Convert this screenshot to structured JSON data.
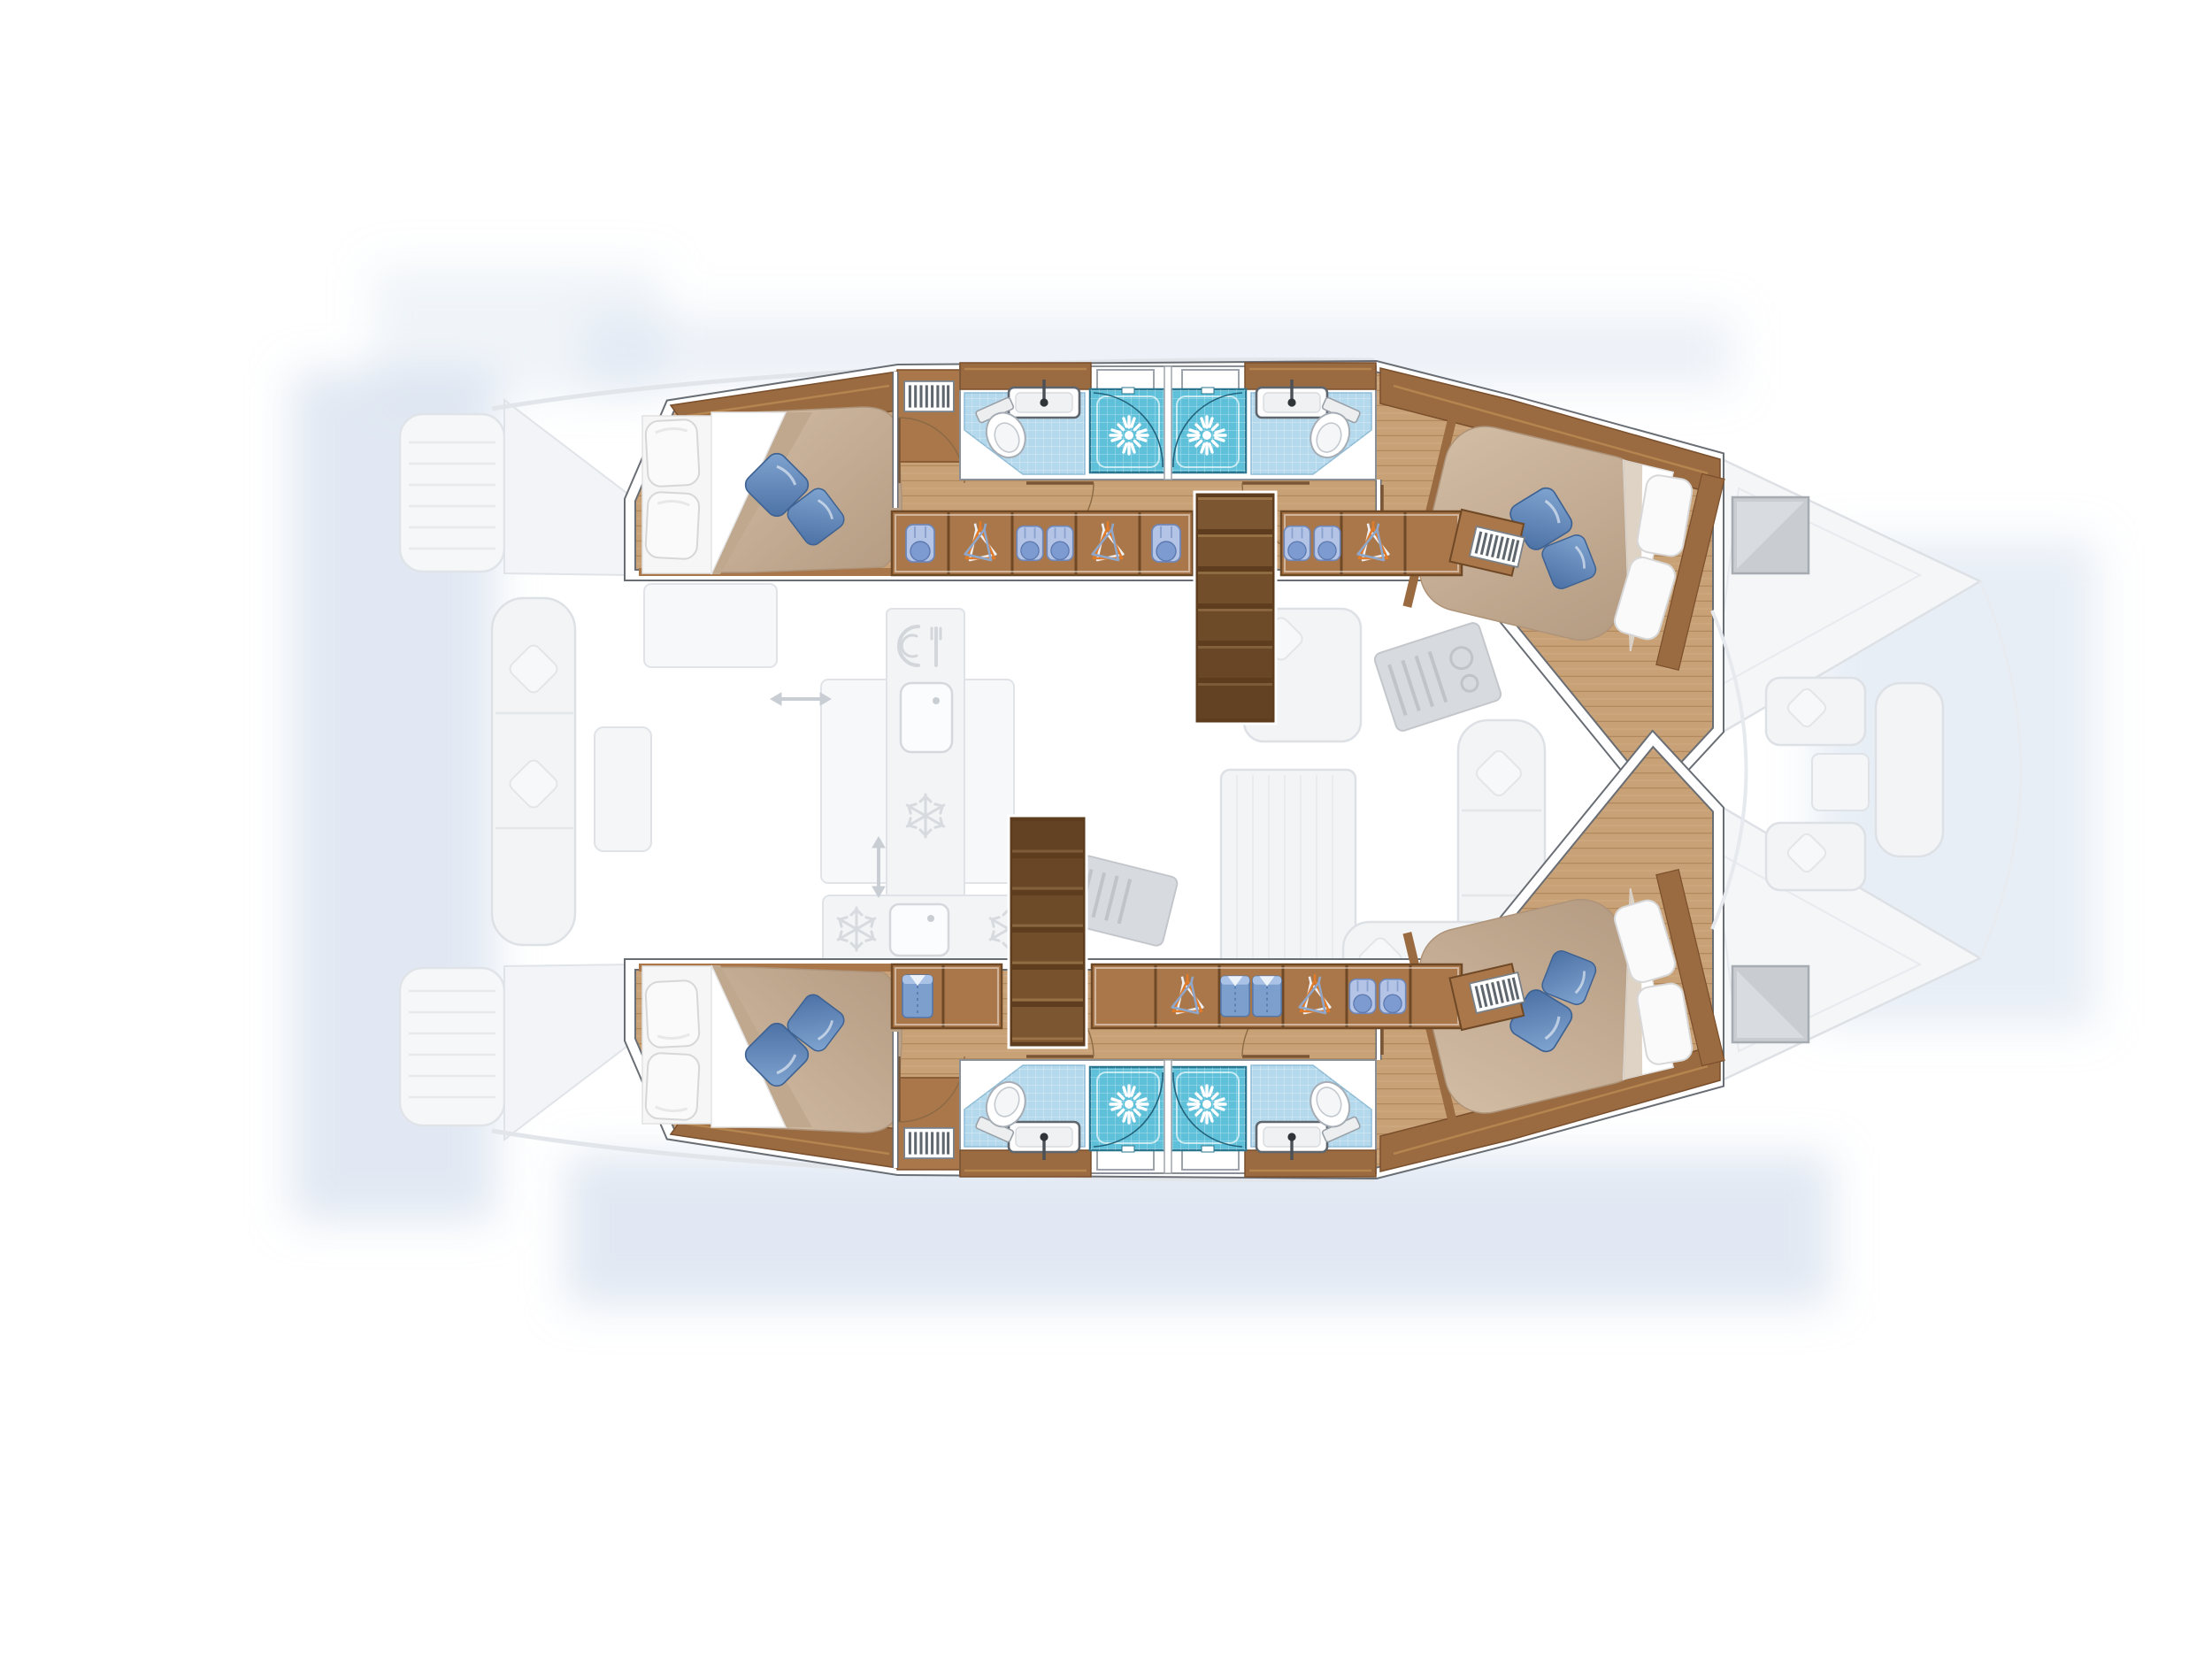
{
  "page": {
    "background_color": "#FFFFFF",
    "content": "Catamaran yacht interior floor plan, top-down view, bow pointing right; hull interiors rendered in colour, saloon and decks ghosted in light grey"
  },
  "legend_counts": {
    "cabins": 4,
    "double_beds": 4,
    "bathrooms": 4,
    "toilets": 4,
    "washbasins": 4,
    "shower_stalls": 4,
    "companionway_stairs": 2
  },
  "hulls": [
    {
      "name": "port hull (top)",
      "aft_cabin": {
        "bed": "island double bed",
        "white_pillows": 2,
        "blue_accent_pillows": 2,
        "features": [
          "overhead locker band",
          "corner locker with vent grille",
          "foot bench",
          "entry door"
        ]
      },
      "bathrooms": {
        "count": 2,
        "arrangement": "back-to-back amidships",
        "each_has": [
          "wood vanity shelf",
          "washbasin with mixer tap",
          "marine toilet",
          "pale blue tiled floor",
          "hull window"
        ],
        "shower_stalls": 2
      },
      "forward_cabin": {
        "bed": "island double bed angled toward bow",
        "white_pillows": 2,
        "blue_accent_pillows": 2,
        "features": [
          "overhead locker band",
          "vent grille",
          "entry door"
        ]
      },
      "wardrobe_row": [
        "toiletry bag",
        "hangers",
        "two toiletry bags",
        "hangers",
        "toiletry bag",
        "two toiletry bags",
        "hangers",
        "vent grille"
      ],
      "companionway": "steps just forward of the showers, inboard side"
    },
    {
      "name": "starboard hull (bottom, mirrored)",
      "aft_cabin": {
        "bed": "island double bed",
        "white_pillows": 2,
        "blue_accent_pillows": 2,
        "features": [
          "overhead locker band",
          "corner locker with vent grille",
          "foot bench",
          "entry door"
        ]
      },
      "bathrooms": {
        "count": 2,
        "arrangement": "back-to-back amidships",
        "each_has": [
          "wood vanity shelf",
          "washbasin with mixer tap",
          "marine toilet",
          "pale blue tiled floor",
          "hull window"
        ],
        "shower_stalls": 2
      },
      "forward_cabin": {
        "bed": "island double bed angled toward bow",
        "white_pillows": 2,
        "blue_accent_pillows": 2,
        "features": [
          "overhead locker band",
          "vent grille",
          "entry door"
        ]
      },
      "wardrobe_row": [
        "folded shirt",
        "double locker",
        "hangers",
        "two folded shirts",
        "hangers",
        "two toiletry bags",
        "vent grille"
      ],
      "companionway": "steps just aft of the showers, inboard side"
    }
  ],
  "ghosted_deck": {
    "saloon": [
      "galley counter",
      "galley sink",
      "crockery icon (plate and cutlery)",
      "snowflake fridge icons",
      "galley island",
      "angled stove appliances",
      "dining table",
      "L-shaped sofa with pillows",
      "chaise seats",
      "sliding-door double arrows"
    ],
    "aft_cockpit": [
      "swim platform steps on each transom",
      "aft bench sofa with scatter pillows",
      "cockpit table",
      "teak plank deck"
    ],
    "foredeck": [
      "grey deck hatch on each bow",
      "forward cockpit bench",
      "two seat pads with pillows",
      "forward table",
      "bow bridle lines"
    ]
  },
  "colors": {
    "cabin_sole_wood": "#C9A176",
    "cabinet_wood": "#9A6A41",
    "stair_wood_dark": "#5E3D1F",
    "duvet_beige": "#C7B097",
    "pillow_white": "#FAFAFA",
    "pillow_blue": "#5D86BA",
    "bathroom_tile_blue": "#B5D9EC",
    "shower_tile_cyan": "#5FC0DA",
    "wall_white": "#FFFFFF",
    "ghost_fill": "#F2F4F6",
    "ghost_stroke": "#DDE1E5",
    "shadow_blue": "#C3D2E8",
    "hanger_orange": "#E07B2A",
    "shirt_blue": "#7D9FCE",
    "hatch_gray": "#C9CDD2"
  },
  "icons": [
    "shower-spray-icon",
    "toilet-icon",
    "washbasin-icon",
    "hanger-icon",
    "folded-shirt-icon",
    "toiletry-bag-icon",
    "vent-grille-icon",
    "snowflake-icon",
    "plate-fork-icon",
    "double-arrow-icon",
    "deck-hatch-icon"
  ]
}
